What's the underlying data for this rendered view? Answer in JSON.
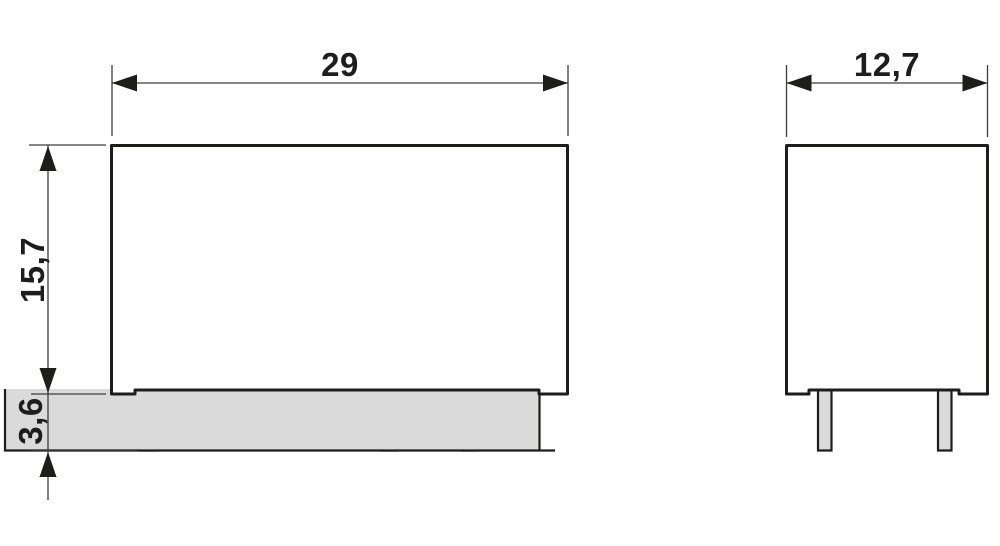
{
  "drawing": {
    "type": "technical-dimension-drawing",
    "front_view": {
      "width_label": "29",
      "height_label": "15,7",
      "pin_length_label": "3,6",
      "pin_count": 4
    },
    "side_view": {
      "width_label": "12,7",
      "pin_count": 2
    },
    "colors": {
      "outline": "#1d1d1b",
      "dim_line": "#3d3d3c",
      "pin_fill": "#dadada",
      "label": "#1d1d1b",
      "background": "#ffffff"
    }
  }
}
